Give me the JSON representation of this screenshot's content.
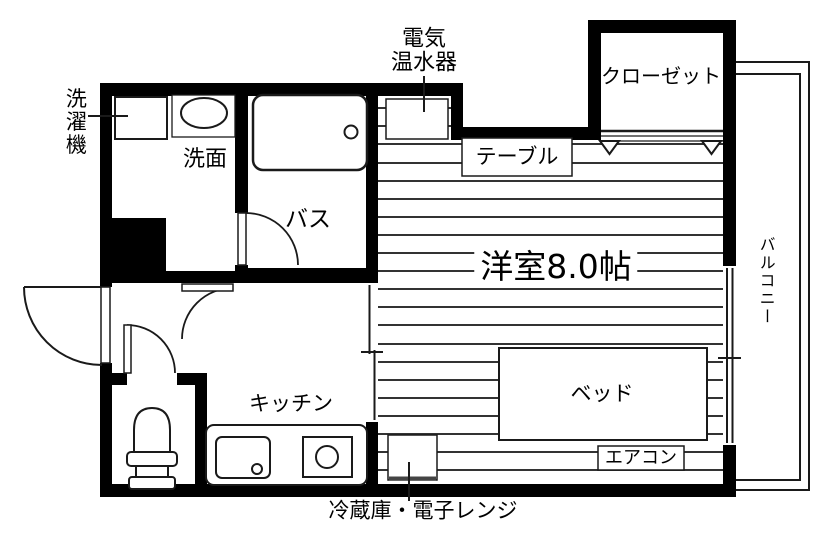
{
  "labels": {
    "laundry": "洗濯機",
    "washbasin": "洗面",
    "bath": "バス",
    "heater_line1": "電気",
    "heater_line2": "温水器",
    "table": "テーブル",
    "closet": "クローゼット",
    "main_room": "洋室8.0帖",
    "balcony": "バルコニー",
    "bed": "ベッド",
    "aircon": "エアコン",
    "kitchen": "キッチン",
    "fridge": "冷蔵庫・電子レンジ"
  },
  "colors": {
    "wall": "#000000",
    "line": "#1a1a1a",
    "floor_line": "#333333",
    "background": "#ffffff"
  }
}
